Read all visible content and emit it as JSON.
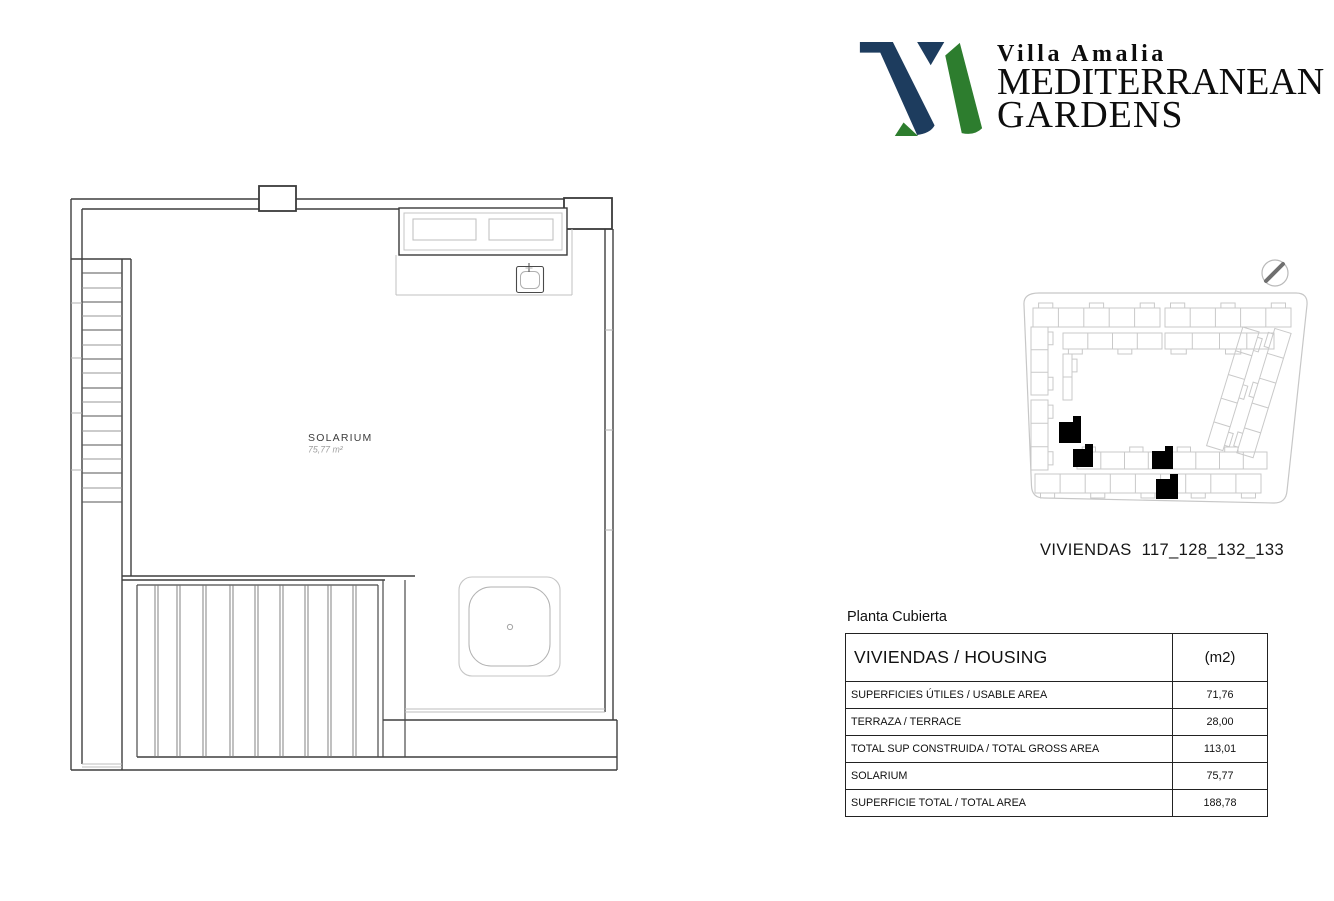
{
  "brand": {
    "line1": "Villa Amalia",
    "line2": "MEDITERRANEAN",
    "line3": "GARDENS",
    "navy": "#1d3c5e",
    "green": "#2d7d2e"
  },
  "floor_plan": {
    "room_label": "SOLARIUM",
    "room_area": "75,77 m²"
  },
  "site_plan": {
    "caption": "VIVIENDAS  117_128_132_133",
    "highlight_color": "#000000"
  },
  "table": {
    "title": "Planta Cubierta",
    "header": {
      "housing": "VIVIENDAS / HOUSING",
      "unit": "(m2)"
    },
    "rows": [
      {
        "label": "SUPERFICIES ÚTILES / USABLE AREA",
        "value": "71,76"
      },
      {
        "label": "TERRAZA / TERRACE",
        "value": "28,00"
      },
      {
        "label": "TOTAL SUP CONSTRUIDA / TOTAL GROSS AREA",
        "value": "113,01"
      },
      {
        "label": "SOLARIUM",
        "value": "75,77"
      },
      {
        "label": "SUPERFICIE TOTAL / TOTAL AREA",
        "value": "188,78"
      }
    ]
  }
}
